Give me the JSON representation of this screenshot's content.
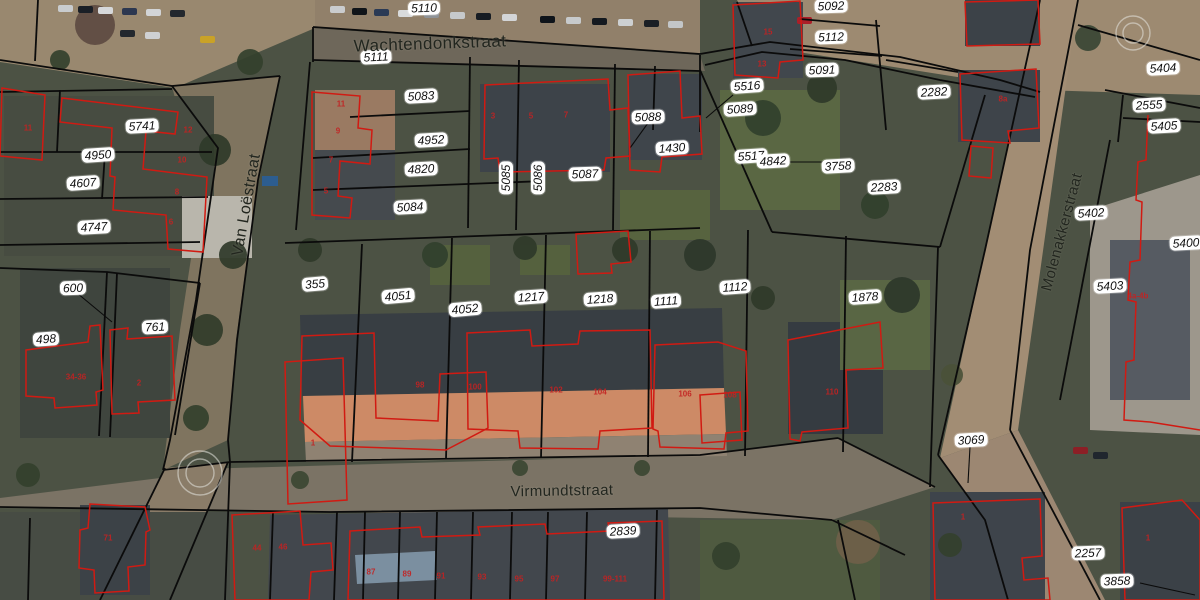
{
  "map_title": "Cadastral aerial map",
  "colors": {
    "base": "#4c5244",
    "boundary": "#0b0b0b",
    "building_outline": "#d11a12",
    "label_bg": "#ffffff",
    "label_text": "#111111",
    "street_text": "#22261f",
    "house_number": "#c32222",
    "symbol_stroke": "#e6e6e0"
  },
  "streets": [
    {
      "name": "Wachtendonkstraat",
      "x": 430,
      "y": 44,
      "rot": -2,
      "size": 17
    },
    {
      "name": "Van Loëstraat",
      "x": 247,
      "y": 205,
      "rot": -80,
      "size": 16
    },
    {
      "name": "Virmundtstraat",
      "x": 562,
      "y": 491,
      "rot": -1,
      "size": 15
    },
    {
      "name": "Molenakkerstraat",
      "x": 1062,
      "y": 232,
      "rot": -75,
      "size": 15
    }
  ],
  "parcels": [
    {
      "id": "5110",
      "x": 424,
      "y": 8,
      "rot": -2
    },
    {
      "id": "5111",
      "x": 376,
      "y": 57,
      "rot": -3
    },
    {
      "id": "5083",
      "x": 421,
      "y": 96,
      "rot": -3
    },
    {
      "id": "4952",
      "x": 431,
      "y": 140,
      "rot": -3
    },
    {
      "id": "4820",
      "x": 421,
      "y": 169,
      "rot": -3
    },
    {
      "id": "5084",
      "x": 410,
      "y": 207,
      "rot": -3
    },
    {
      "id": "5085",
      "x": 506,
      "y": 178,
      "rot": -90
    },
    {
      "id": "5086",
      "x": 538,
      "y": 178,
      "rot": -90
    },
    {
      "id": "5087",
      "x": 585,
      "y": 174,
      "rot": -2
    },
    {
      "id": "5088",
      "x": 648,
      "y": 117,
      "rot": -2
    },
    {
      "id": "1430",
      "x": 672,
      "y": 148,
      "rot": -4
    },
    {
      "id": "5516",
      "x": 747,
      "y": 86,
      "rot": -4
    },
    {
      "id": "5089",
      "x": 740,
      "y": 109,
      "rot": -4
    },
    {
      "id": "5091",
      "x": 822,
      "y": 70,
      "rot": -2
    },
    {
      "id": "5112",
      "x": 831,
      "y": 37,
      "rot": -2
    },
    {
      "id": "5092",
      "x": 831,
      "y": 6,
      "rot": -2
    },
    {
      "id": "5517",
      "x": 751,
      "y": 156,
      "rot": -4
    },
    {
      "id": "4842",
      "x": 773,
      "y": 161,
      "rot": -3
    },
    {
      "id": "3758",
      "x": 838,
      "y": 166,
      "rot": -3
    },
    {
      "id": "2282",
      "x": 934,
      "y": 92,
      "rot": -3
    },
    {
      "id": "2283",
      "x": 884,
      "y": 187,
      "rot": -3
    },
    {
      "id": "5741",
      "x": 142,
      "y": 126,
      "rot": -3
    },
    {
      "id": "4950",
      "x": 98,
      "y": 155,
      "rot": -4
    },
    {
      "id": "4607",
      "x": 83,
      "y": 183,
      "rot": -4
    },
    {
      "id": "4747",
      "x": 94,
      "y": 227,
      "rot": -3
    },
    {
      "id": "600",
      "x": 73,
      "y": 288,
      "rot": -2
    },
    {
      "id": "761",
      "x": 155,
      "y": 327,
      "rot": -3
    },
    {
      "id": "498",
      "x": 46,
      "y": 339,
      "rot": -4
    },
    {
      "id": "355",
      "x": 315,
      "y": 284,
      "rot": -5
    },
    {
      "id": "4051",
      "x": 398,
      "y": 296,
      "rot": -5
    },
    {
      "id": "4052",
      "x": 465,
      "y": 309,
      "rot": -5
    },
    {
      "id": "1217",
      "x": 531,
      "y": 297,
      "rot": -4
    },
    {
      "id": "1218",
      "x": 600,
      "y": 299,
      "rot": -4
    },
    {
      "id": "1111",
      "x": 666,
      "y": 301,
      "rot": -4
    },
    {
      "id": "1112",
      "x": 735,
      "y": 287,
      "rot": -4
    },
    {
      "id": "1878",
      "x": 865,
      "y": 297,
      "rot": -4
    },
    {
      "id": "2839",
      "x": 623,
      "y": 531,
      "rot": -3
    },
    {
      "id": "3069",
      "x": 971,
      "y": 440,
      "rot": -3
    },
    {
      "id": "5404",
      "x": 1163,
      "y": 68,
      "rot": -3
    },
    {
      "id": "2555",
      "x": 1149,
      "y": 105,
      "rot": -3
    },
    {
      "id": "5405",
      "x": 1164,
      "y": 126,
      "rot": -3
    },
    {
      "id": "5402",
      "x": 1091,
      "y": 213,
      "rot": -3
    },
    {
      "id": "5400",
      "x": 1186,
      "y": 243,
      "rot": -3
    },
    {
      "id": "5403",
      "x": 1110,
      "y": 286,
      "rot": -3
    },
    {
      "id": "2257",
      "x": 1088,
      "y": 553,
      "rot": -2
    },
    {
      "id": "3858",
      "x": 1117,
      "y": 581,
      "rot": -2
    }
  ],
  "house_numbers": [
    {
      "t": "11",
      "x": 28,
      "y": 128
    },
    {
      "t": "11",
      "x": 341,
      "y": 104
    },
    {
      "t": "9",
      "x": 338,
      "y": 131
    },
    {
      "t": "7",
      "x": 331,
      "y": 160
    },
    {
      "t": "5",
      "x": 326,
      "y": 191
    },
    {
      "t": "12",
      "x": 188,
      "y": 130
    },
    {
      "t": "10",
      "x": 182,
      "y": 160
    },
    {
      "t": "8",
      "x": 177,
      "y": 192
    },
    {
      "t": "6",
      "x": 171,
      "y": 222
    },
    {
      "t": "15",
      "x": 768,
      "y": 32
    },
    {
      "t": "13",
      "x": 762,
      "y": 64
    },
    {
      "t": "8a",
      "x": 1003,
      "y": 99
    },
    {
      "t": "34-36",
      "x": 76,
      "y": 377
    },
    {
      "t": "2",
      "x": 139,
      "y": 383
    },
    {
      "t": "3",
      "x": 493,
      "y": 116
    },
    {
      "t": "5",
      "x": 531,
      "y": 116
    },
    {
      "t": "7",
      "x": 566,
      "y": 115
    },
    {
      "t": "98",
      "x": 420,
      "y": 385
    },
    {
      "t": "100",
      "x": 475,
      "y": 387
    },
    {
      "t": "102",
      "x": 556,
      "y": 390
    },
    {
      "t": "104",
      "x": 600,
      "y": 392
    },
    {
      "t": "106",
      "x": 685,
      "y": 394
    },
    {
      "t": "108",
      "x": 730,
      "y": 395
    },
    {
      "t": "110",
      "x": 832,
      "y": 392
    },
    {
      "t": "1",
      "x": 313,
      "y": 443
    },
    {
      "t": "71",
      "x": 108,
      "y": 538
    },
    {
      "t": "44",
      "x": 257,
      "y": 548
    },
    {
      "t": "46",
      "x": 283,
      "y": 547
    },
    {
      "t": "87",
      "x": 371,
      "y": 572
    },
    {
      "t": "89",
      "x": 407,
      "y": 574
    },
    {
      "t": "91",
      "x": 441,
      "y": 576
    },
    {
      "t": "93",
      "x": 482,
      "y": 577
    },
    {
      "t": "95",
      "x": 519,
      "y": 579
    },
    {
      "t": "97",
      "x": 555,
      "y": 579
    },
    {
      "t": "99-111",
      "x": 615,
      "y": 579
    },
    {
      "t": "4a-4b",
      "x": 1138,
      "y": 296
    },
    {
      "t": "1",
      "x": 963,
      "y": 517
    },
    {
      "t": "1",
      "x": 1148,
      "y": 538
    }
  ],
  "symbols": [
    {
      "type": "double-circle",
      "x": 1133,
      "y": 33,
      "r1": 17,
      "r2": 10
    },
    {
      "type": "double-circle",
      "x": 200,
      "y": 473,
      "r1": 22,
      "r2": 14
    }
  ],
  "boundary_lines": [
    "313,27 700,54",
    "313,27 313,62",
    "313,60 700,71",
    "0,60 172,86",
    "172,86 218,148 196,300 170,440 163,470",
    "280,76 258,180 237,340 228,440 230,462",
    "172,86 280,76",
    "38,0 35,61",
    "0,92 172,89",
    "0,152 212,152",
    "60,90 57,152",
    "0,199 208,197",
    "0,245 200,242",
    "105,152 102,199",
    "0,268 107,272 200,283",
    "107,272 99,436",
    "117,273 110,437",
    "200,283 175,435",
    "163,470 230,462 700,455 838,438",
    "838,438 935,487",
    "0,507 330,512 700,508 832,520",
    "832,520 905,555",
    "285,243 700,228",
    "700,70 772,232",
    "772,232 940,247",
    "362,244 352,462",
    "452,238 446,459",
    "546,235 541,458",
    "650,231 648,457",
    "748,230 745,456",
    "846,236 843,452",
    "938,247 930,487",
    "310,62 296,230",
    "470,57 468,228",
    "519,60 516,230",
    "615,64 613,230",
    "655,66 653,130",
    "700,55 700,132",
    "350,117 470,111",
    "313,158 470,149",
    "313,190 545,181",
    "700,54 770,42 900,57 1000,80 1040,92",
    "737,2 752,46",
    "705,65 762,52 845,60 940,80 1035,97",
    "800,19 880,26",
    "790,49 882,56",
    "876,20 886,130",
    "886,60 958,72",
    "985,95 940,247",
    "1040,0 985,250 938,455",
    "1078,0 1030,250 1010,430",
    "938,455 985,520 1008,600",
    "1010,430 1100,600",
    "1078,25 1200,60",
    "1105,90 1200,108",
    "1123,95 1118,142",
    "1123,118 1200,122",
    "1110,140 1060,400",
    "230,462 225,600",
    "273,512 270,600",
    "337,512 334,600",
    "365,512 363,600",
    "400,512 398,600",
    "437,512 435,600",
    "473,512 471,600",
    "512,512 510,600",
    "548,512 546,600",
    "587,512 585,600",
    "657,510 655,600",
    "838,520 855,600",
    "30,518 28,600",
    "165,468 100,600",
    "228,462 170,600"
  ],
  "pointer_lines": [
    "648,123 630,148",
    "77,293 112,322",
    "970,447 968,483",
    "1140,583 1195,595",
    "788,162 838,162",
    "733,95 706,118"
  ],
  "building_outlines": [
    "312,92 360,96 358,128 372,130 370,164 340,161 338,196 352,198 350,218 312,215",
    "485,85 608,79 610,110 628,108 630,156 606,158 604,170 500,172 498,158 484,159",
    "628,75 680,71 682,118 700,116 702,154 662,157 660,172 630,170",
    "733,5 800,1 803,60 780,62 778,78 735,75",
    "62,98 178,112 175,134 146,131 143,169 207,177 203,252 168,249 166,215 113,210 115,177 110,176 112,128 60,122",
    "2,88 45,95 42,160 0,156",
    "960,74 1036,69 1039,128 1008,131 1010,143 962,140",
    "971,146 993,148 991,178 969,176",
    "965,2 1038,0 1040,44 967,46",
    "26,350 88,342 90,326 100,325 103,390 96,392 97,405 55,408 54,398 26,396",
    "110,330 128,328 127,339 172,336 175,400 138,402 139,413 112,414",
    "90,504 145,507 150,530 146,532 145,565 128,567 129,591 95,593 94,570 79,568 80,530 88,528",
    "285,362 343,358 347,500 288,504",
    "302,336 374,333 376,418 438,421 440,374 486,372 488,428 446,450 330,446 300,420",
    "467,333 530,330 532,346 578,344 580,331 650,330 652,428 600,431 598,449 520,448 518,431 468,429",
    "576,234 628,231 631,262 611,264 612,273 578,274",
    "655,345 718,342 746,351 748,431 726,433 724,449 660,447 658,431 653,429",
    "788,340 880,322 883,368 846,370 848,428 802,432 800,441 790,439",
    "open:1148,115 1146,160 1138,162 1136,200 1142,202 1140,260 1130,262 1128,300 1136,302 1134,360 1126,362 1124,420 1150,422 1200,430",
    "933,503 1040,499 1042,556 1022,558 1024,580 1048,578 1050,600 935,600",
    "1122,508 1182,500 1200,520 1200,600 1125,600",
    "350,531 420,527 422,537 480,535 478,527 545,524 547,534 610,531 608,523 662,521 664,600 348,600",
    "232,515 300,511 303,545 331,543 333,570 311,572 309,600 235,600",
    "700,395 740,392 742,440 702,443"
  ],
  "scenery": {
    "patches": [
      {
        "pts": "0,0 315,0 315,28 175,88 0,62",
        "fill": "#99886f"
      },
      {
        "pts": "315,0 700,0 700,54 315,28",
        "fill": "#91806a"
      },
      {
        "pts": "313,28 700,55 705,71 313,61",
        "fill": "#6e675a"
      },
      {
        "pts": "700,0 1200,0 1200,95 1040,90 760,46 737,0",
        "fill": "#9d8a71"
      },
      {
        "pts": "1040,0 1078,0 1018,430 940,458 985,250",
        "fill": "#a28d74"
      },
      {
        "pts": "940,458 1018,430 1105,600 1008,600 983,520",
        "fill": "#9c8772"
      },
      {
        "pts": "163,470 700,455 838,438 935,487 832,520 330,512 0,508 0,498 160,478",
        "fill": "#7b7365"
      },
      {
        "pts": "172,86 280,76 255,200 236,340 228,440 163,470 180,330 200,200",
        "fill": "#7f745f"
      },
      {
        "pts": "165,468 228,462 172,600 98,600",
        "fill": "#8a7c68"
      },
      {
        "x": 4,
        "y": 96,
        "w": 210,
        "h": 160,
        "fill": "#474c41"
      },
      {
        "x": 20,
        "y": 268,
        "w": 150,
        "h": 170,
        "fill": "#3f453e"
      },
      {
        "x": 182,
        "y": 196,
        "w": 70,
        "h": 62,
        "fill": "#b9b6ac"
      },
      {
        "pts": "300,315 722,308 724,388 302,396",
        "fill": "#383e43"
      },
      {
        "pts": "303,396 724,388 726,434 305,442",
        "fill": "#cd8a66"
      },
      {
        "pts": "305,442 726,434 727,456 306,462",
        "fill": "#8f8272"
      },
      {
        "x": 480,
        "y": 84,
        "w": 130,
        "h": 88,
        "fill": "#3d4349"
      },
      {
        "x": 315,
        "y": 90,
        "w": 80,
        "h": 60,
        "fill": "#9a7a62"
      },
      {
        "x": 315,
        "y": 150,
        "w": 80,
        "h": 70,
        "fill": "#454a4e"
      },
      {
        "x": 628,
        "y": 74,
        "w": 74,
        "h": 86,
        "fill": "#3f454b"
      },
      {
        "x": 733,
        "y": 2,
        "w": 70,
        "h": 76,
        "fill": "#41474d"
      },
      {
        "x": 958,
        "y": 70,
        "w": 82,
        "h": 72,
        "fill": "#3e444a"
      },
      {
        "x": 965,
        "y": 0,
        "w": 75,
        "h": 46,
        "fill": "#3c4248"
      },
      {
        "x": 788,
        "y": 322,
        "w": 95,
        "h": 112,
        "fill": "#353b41"
      },
      {
        "pts": "1090,210 1200,175 1200,435 1090,430",
        "fill": "#9d978c"
      },
      {
        "x": 1110,
        "y": 240,
        "w": 80,
        "h": 160,
        "fill": "#565b62"
      },
      {
        "x": 930,
        "y": 492,
        "w": 115,
        "h": 108,
        "fill": "#3e444b"
      },
      {
        "x": 1120,
        "y": 502,
        "w": 80,
        "h": 98,
        "fill": "#3b4147"
      },
      {
        "pts": "270,515 668,508 670,600 268,600",
        "fill": "#42474d"
      },
      {
        "pts": "355,555 435,551 437,580 357,584",
        "fill": "#7b8fa0"
      },
      {
        "x": 0,
        "y": 512,
        "w": 230,
        "h": 88,
        "fill": "#474c44"
      },
      {
        "x": 80,
        "y": 505,
        "w": 70,
        "h": 90,
        "fill": "#3c4247"
      },
      {
        "x": 720,
        "y": 90,
        "w": 120,
        "h": 120,
        "fill": "#5a6743"
      },
      {
        "x": 620,
        "y": 190,
        "w": 90,
        "h": 50,
        "fill": "#57633f"
      },
      {
        "x": 840,
        "y": 280,
        "w": 90,
        "h": 90,
        "fill": "#596644"
      },
      {
        "x": 430,
        "y": 245,
        "w": 60,
        "h": 40,
        "fill": "#55613e"
      },
      {
        "x": 520,
        "y": 245,
        "w": 50,
        "h": 30,
        "fill": "#55613e"
      },
      {
        "x": 700,
        "y": 520,
        "w": 180,
        "h": 80,
        "fill": "#4f5a40"
      },
      {
        "x": 262,
        "y": 176,
        "w": 16,
        "h": 10,
        "fill": "#2d5d8f"
      }
    ],
    "trees": [
      {
        "x": 95,
        "y": 25,
        "r": 20,
        "fill": "#5d4a41"
      },
      {
        "x": 250,
        "y": 62,
        "r": 13,
        "fill": "#33402c"
      },
      {
        "x": 215,
        "y": 150,
        "r": 16,
        "fill": "#2f3a29"
      },
      {
        "x": 233,
        "y": 255,
        "r": 14,
        "fill": "#2f3a29"
      },
      {
        "x": 207,
        "y": 330,
        "r": 16,
        "fill": "#313c2a"
      },
      {
        "x": 196,
        "y": 418,
        "r": 13,
        "fill": "#33402c"
      },
      {
        "x": 310,
        "y": 250,
        "r": 12,
        "fill": "#2f3a29"
      },
      {
        "x": 435,
        "y": 255,
        "r": 13,
        "fill": "#31402c"
      },
      {
        "x": 525,
        "y": 248,
        "r": 12,
        "fill": "#2f3a29"
      },
      {
        "x": 625,
        "y": 250,
        "r": 13,
        "fill": "#2f3a29"
      },
      {
        "x": 700,
        "y": 255,
        "r": 16,
        "fill": "#2c372a"
      },
      {
        "x": 763,
        "y": 118,
        "r": 18,
        "fill": "#31402c"
      },
      {
        "x": 822,
        "y": 88,
        "r": 15,
        "fill": "#2f3a29"
      },
      {
        "x": 875,
        "y": 205,
        "r": 14,
        "fill": "#31402c"
      },
      {
        "x": 902,
        "y": 295,
        "r": 18,
        "fill": "#2c372a"
      },
      {
        "x": 763,
        "y": 298,
        "r": 12,
        "fill": "#2f3a29"
      },
      {
        "x": 1088,
        "y": 38,
        "r": 13,
        "fill": "#3a4534"
      },
      {
        "x": 952,
        "y": 375,
        "r": 11,
        "fill": "#4a5138"
      },
      {
        "x": 300,
        "y": 480,
        "r": 9,
        "fill": "#3b4632"
      },
      {
        "x": 520,
        "y": 468,
        "r": 8,
        "fill": "#3b4632"
      },
      {
        "x": 642,
        "y": 468,
        "r": 8,
        "fill": "#3b4632"
      },
      {
        "x": 726,
        "y": 556,
        "r": 14,
        "fill": "#33402c"
      },
      {
        "x": 858,
        "y": 542,
        "r": 22,
        "fill": "#6f6049"
      },
      {
        "x": 950,
        "y": 545,
        "r": 12,
        "fill": "#33402c"
      },
      {
        "x": 28,
        "y": 475,
        "r": 12,
        "fill": "#33402c"
      },
      {
        "x": 60,
        "y": 60,
        "r": 10,
        "fill": "#33402c"
      }
    ],
    "cars": [
      {
        "x": 58,
        "y": 5,
        "fill": "#c9ccce"
      },
      {
        "x": 78,
        "y": 6,
        "fill": "#1a1f26"
      },
      {
        "x": 98,
        "y": 7,
        "fill": "#d6d8da"
      },
      {
        "x": 122,
        "y": 8,
        "fill": "#2c3750"
      },
      {
        "x": 146,
        "y": 9,
        "fill": "#d2d4d6"
      },
      {
        "x": 170,
        "y": 10,
        "fill": "#23282e"
      },
      {
        "x": 200,
        "y": 36,
        "fill": "#c9a227"
      },
      {
        "x": 120,
        "y": 30,
        "fill": "#23282e"
      },
      {
        "x": 145,
        "y": 32,
        "fill": "#cfd1d3"
      },
      {
        "x": 330,
        "y": 6,
        "fill": "#caccce"
      },
      {
        "x": 352,
        "y": 8,
        "fill": "#101419"
      },
      {
        "x": 374,
        "y": 9,
        "fill": "#2a3a55"
      },
      {
        "x": 398,
        "y": 10,
        "fill": "#d8dadb"
      },
      {
        "x": 424,
        "y": 11,
        "fill": "#8e9296"
      },
      {
        "x": 450,
        "y": 12,
        "fill": "#c6c9cb"
      },
      {
        "x": 476,
        "y": 13,
        "fill": "#171c23"
      },
      {
        "x": 502,
        "y": 14,
        "fill": "#d3d5d7"
      },
      {
        "x": 540,
        "y": 16,
        "fill": "#0f141a"
      },
      {
        "x": 566,
        "y": 17,
        "fill": "#c7cacc"
      },
      {
        "x": 592,
        "y": 18,
        "fill": "#14191f"
      },
      {
        "x": 618,
        "y": 19,
        "fill": "#cdd0d2"
      },
      {
        "x": 644,
        "y": 20,
        "fill": "#1a1f25"
      },
      {
        "x": 668,
        "y": 21,
        "fill": "#c3c6c8"
      },
      {
        "x": 797,
        "y": 17,
        "fill": "#ab1f28"
      },
      {
        "x": 1073,
        "y": 447,
        "fill": "#8c1f26"
      },
      {
        "x": 1093,
        "y": 452,
        "fill": "#20262e"
      }
    ]
  }
}
